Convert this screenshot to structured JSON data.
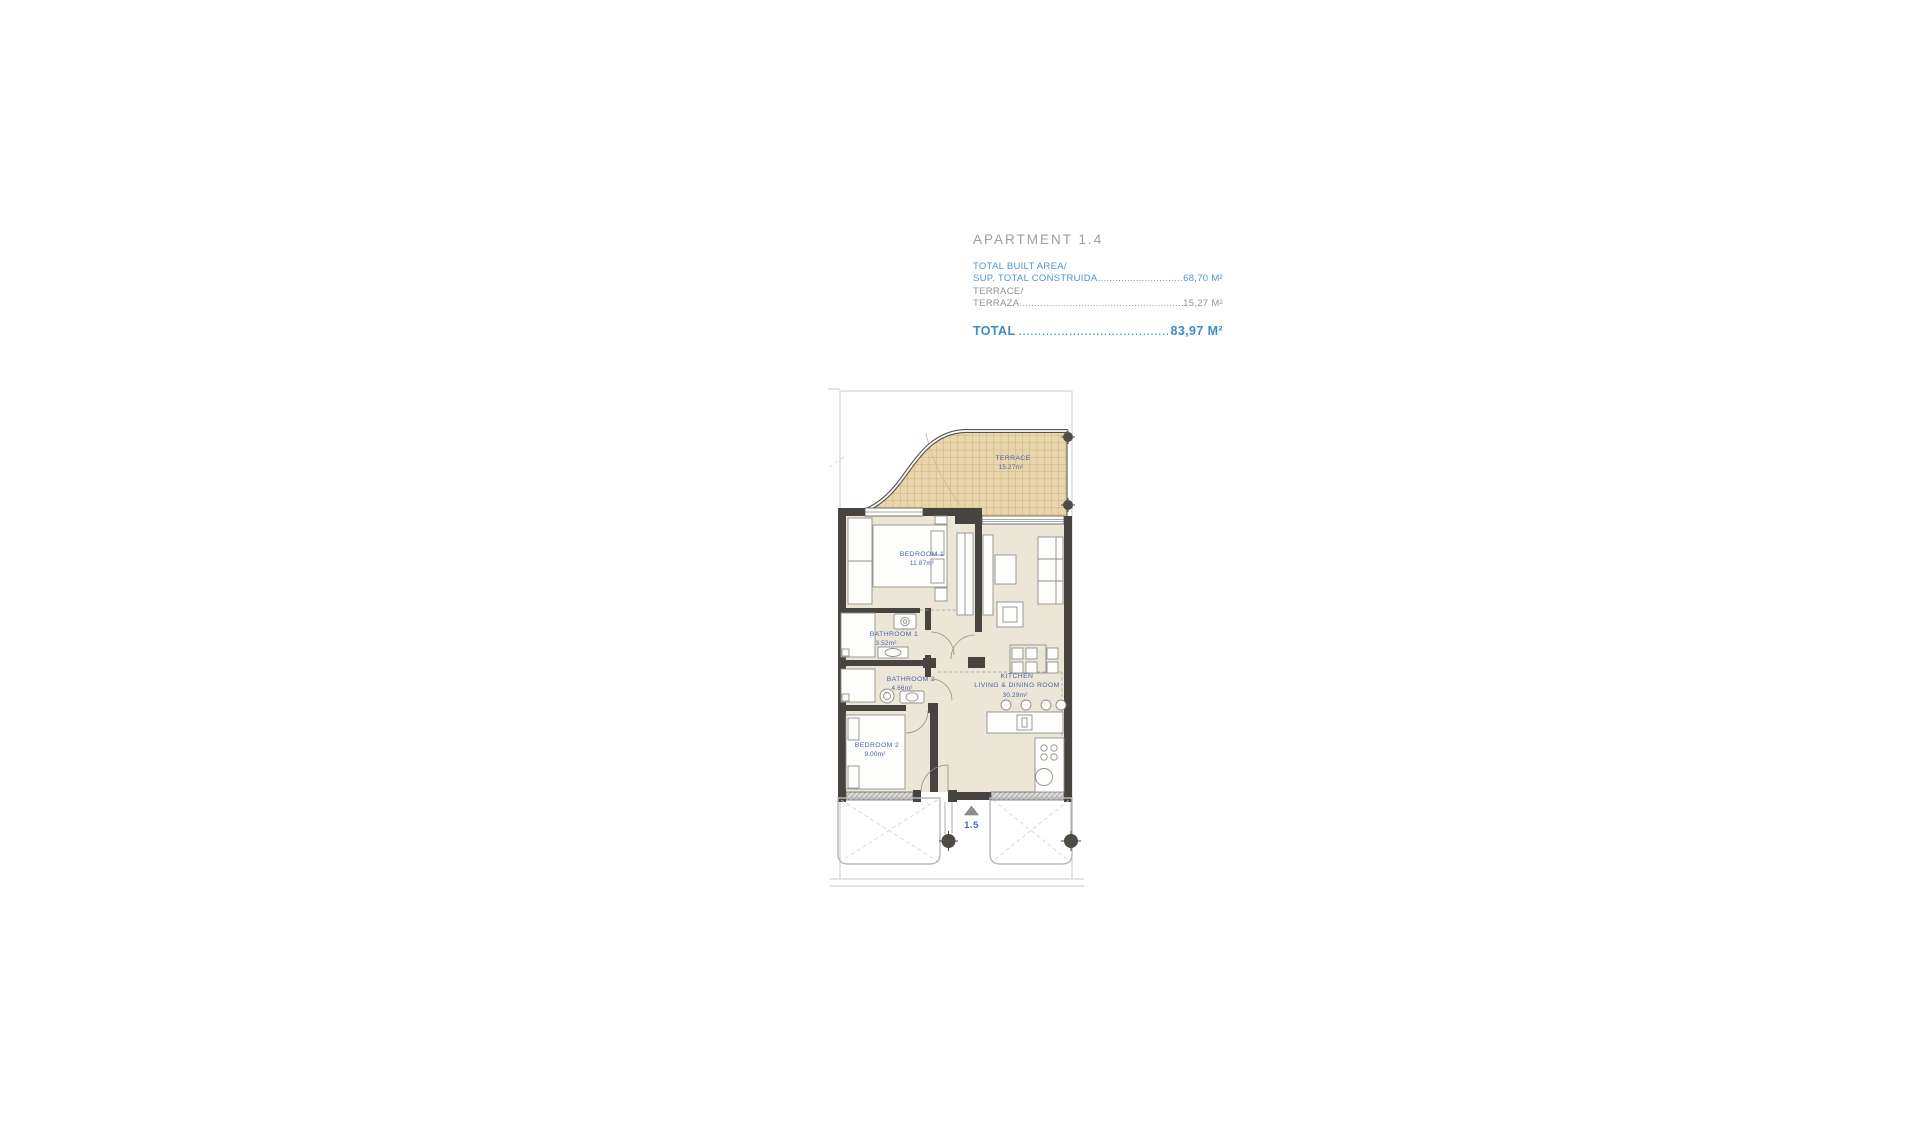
{
  "header": {
    "title": "APARTMENT 1.4",
    "built": {
      "line1": "TOTAL BUILT AREA/",
      "line2": "SUP. TOTAL CONSTRUIDA",
      "leader": "......................................................................",
      "value": "68,70 M²"
    },
    "terrace": {
      "line1": "TERRACE/",
      "line2": "TERRAZA",
      "leader": "......................................................................................",
      "value": "15,27 M²"
    },
    "total": {
      "label": "TOTAL",
      "leader": "......................................................................................",
      "value": "83,97 M²"
    }
  },
  "plan": {
    "terrace": {
      "name": "TERRACE",
      "area": "15.27m²"
    },
    "bedroom1": {
      "name": "BEDROOM  1",
      "area": "11.87m²"
    },
    "bathroom1": {
      "name": "BATHROOM  1",
      "area": "3.52m²"
    },
    "bathroom2": {
      "name": "BATHROOM  2",
      "area": "4.66m²"
    },
    "bedroom2": {
      "name": "BEDROOM  2",
      "area": "9.00m²"
    },
    "kitchen": {
      "name": "KITCHEN",
      "name2": "LIVING  &  DINING  ROOM",
      "area": "30.29m²"
    },
    "adjacent_unit": "1.5"
  },
  "colors": {
    "accent_blue": "#4e96cc",
    "total_blue": "#3e8cc7",
    "plan_label_blue": "#4a63ad",
    "muted_gray": "#8e9497",
    "wall": "#47443f",
    "floor": "#ece6d7",
    "terrace_fill": "#e9d6ac",
    "terrace_grid": "#bfa269"
  }
}
